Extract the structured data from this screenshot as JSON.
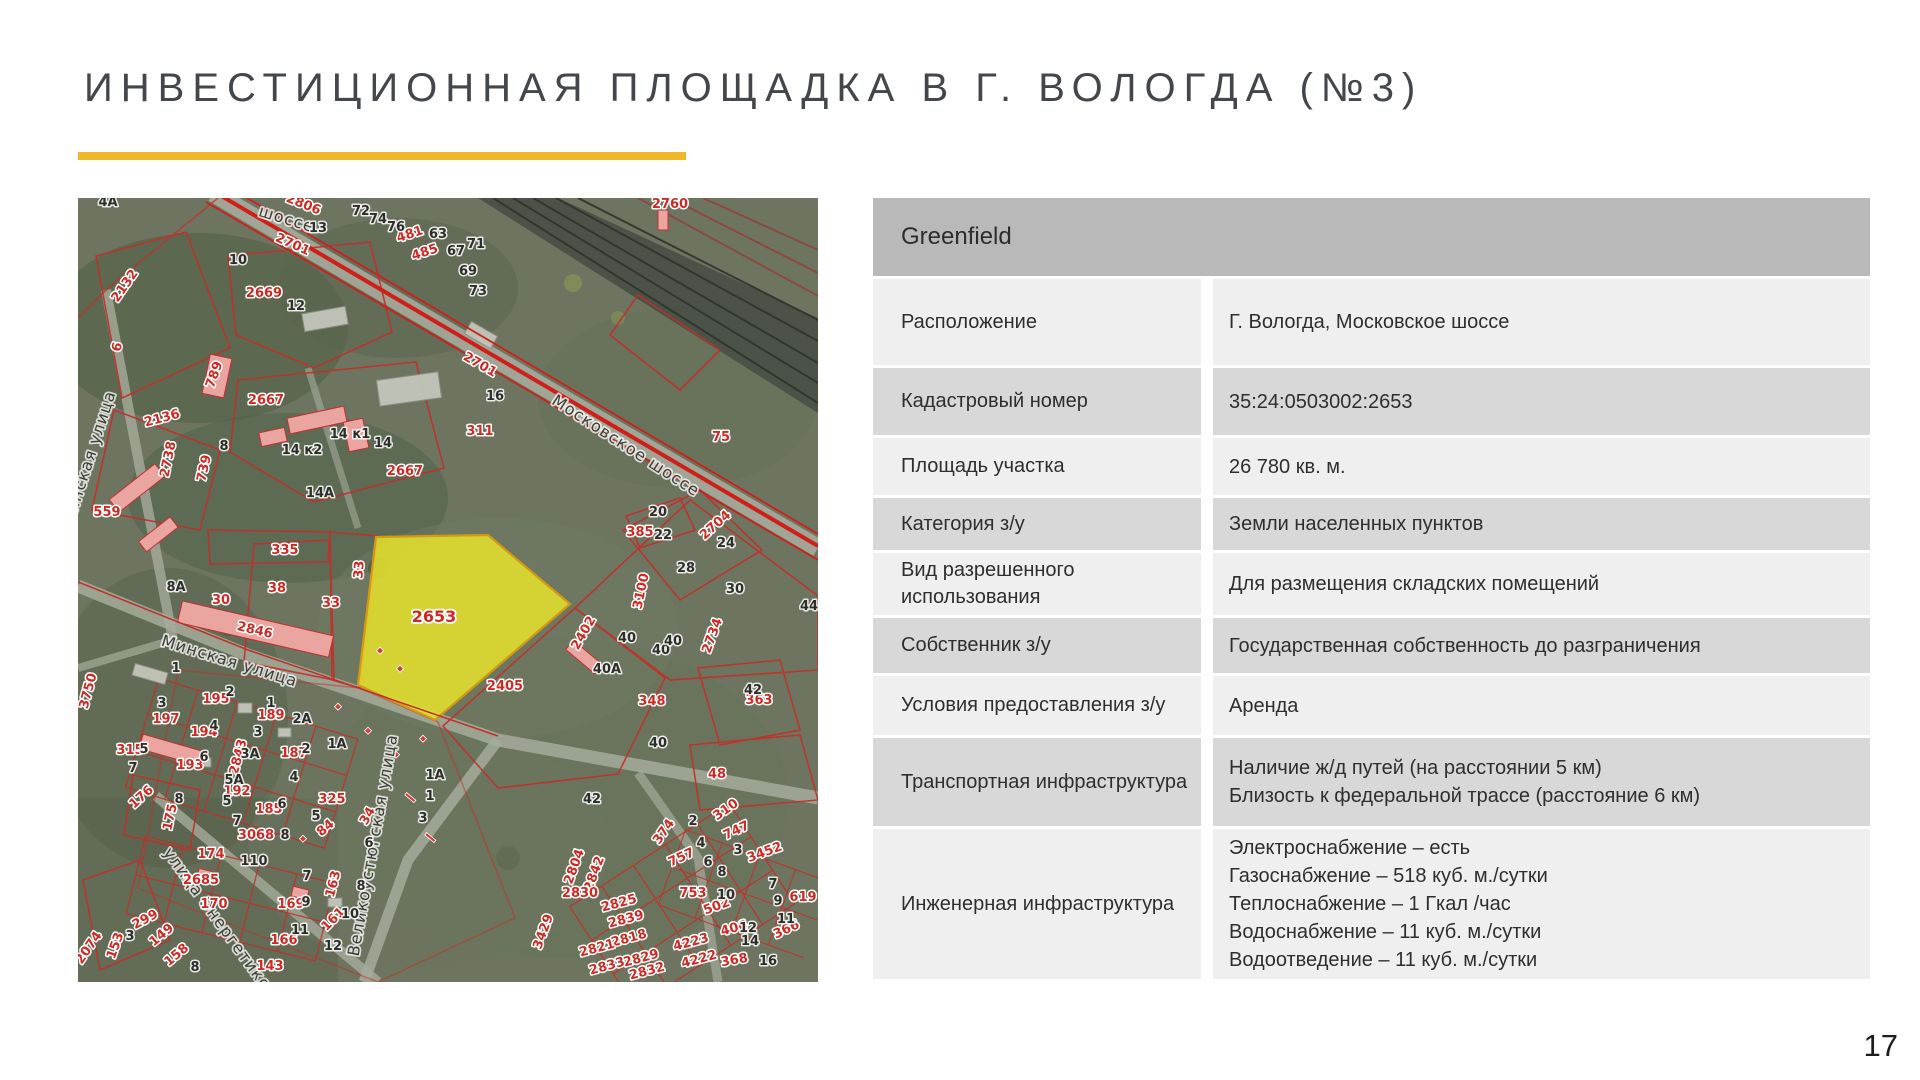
{
  "slide": {
    "title": "ИНВЕСТИЦИОННАЯ ПЛОЩАДКА В Г. ВОЛОГДА (№3)",
    "page_number": "17",
    "accent_color": "#EFB829"
  },
  "table": {
    "header": "Greenfield",
    "shade_light": "#EFEFEF",
    "shade_dark": "#D8D8D8",
    "header_shade": "#B9B9B9",
    "rows": [
      {
        "label": "Расположение",
        "values": [
          "Г. Вологда, Московское шоссе"
        ],
        "shade": "light"
      },
      {
        "label": "Кадастровый номер",
        "values": [
          "35:24:0503002:2653"
        ],
        "shade": "dark"
      },
      {
        "label": "Площадь участка",
        "values": [
          "26 780 кв. м."
        ],
        "shade": "light"
      },
      {
        "label": "Категория з/у",
        "values": [
          "Земли населенных пунктов"
        ],
        "shade": "dark"
      },
      {
        "label": "Вид разрешенного использования",
        "values": [
          "Для размещения складских помещений"
        ],
        "shade": "light"
      },
      {
        "label": "Собственник з/у",
        "values": [
          "Государственная собственность до разграничения"
        ],
        "shade": "dark"
      },
      {
        "label": "Условия предоставления з/у",
        "values": [
          "Аренда"
        ],
        "shade": "light"
      },
      {
        "label": "Транспортная инфраструктура",
        "values": [
          "Наличие ж/д путей (на расстоянии 5 км)",
          "Близость к федеральной трассе (расстояние 6 км)"
        ],
        "shade": "dark"
      },
      {
        "label": "Инженерная инфраструктура",
        "values": [
          "Электроснабжение – есть",
          "Газоснабжение – 518 куб. м./сутки",
          "Теплоснабжение – 1 Гкал /час",
          "Водоснабжение – 11 куб. м./сутки",
          "Водоотведение – 11 куб. м./сутки"
        ],
        "shade": "light"
      }
    ]
  },
  "map": {
    "highlighted_parcel": {
      "number": "2653",
      "fill": "#E4DF2E",
      "x": 356,
      "y": 424
    },
    "parcel_line_color": "#C22F28",
    "street_labels": [
      [
        "шоссе",
        207,
        26,
        17
      ],
      [
        "Московское шоссе",
        545,
        252,
        33
      ],
      [
        "Минская улица",
        150,
        468,
        17
      ],
      [
        "Минская улица",
        16,
        262,
        -72
      ],
      [
        "Великоустюгская улица",
        300,
        648,
        -80
      ],
      [
        "улица Энергетиков",
        138,
        728,
        54
      ]
    ],
    "red_labels": [
      [
        "2760",
        592,
        10,
        0
      ],
      [
        "2806",
        224,
        10,
        22
      ],
      [
        "2701",
        213,
        50,
        24
      ],
      [
        "2701",
        400,
        170,
        30
      ],
      [
        "2132",
        50,
        90,
        -55
      ],
      [
        "2669",
        186,
        99,
        0
      ],
      [
        "481",
        333,
        40,
        -18
      ],
      [
        "485",
        348,
        58,
        -18
      ],
      [
        "789",
        140,
        178,
        -70
      ],
      [
        "2667",
        188,
        206,
        0
      ],
      [
        "2667",
        327,
        277,
        0
      ],
      [
        "311",
        402,
        237,
        0
      ],
      [
        "75",
        643,
        243,
        0
      ],
      [
        "6",
        43,
        150,
        -75
      ],
      [
        "2136",
        85,
        224,
        -15
      ],
      [
        "2738",
        94,
        262,
        -78
      ],
      [
        "739",
        130,
        271,
        -78
      ],
      [
        "559",
        29,
        318,
        0
      ],
      [
        "335",
        207,
        356,
        0
      ],
      [
        "38",
        199,
        394,
        0
      ],
      [
        "33",
        285,
        372,
        -85
      ],
      [
        "33",
        253,
        409,
        0
      ],
      [
        "30",
        143,
        406,
        0
      ],
      [
        "2846",
        176,
        436,
        13
      ],
      [
        "3750",
        14,
        494,
        -75
      ],
      [
        "195",
        138,
        505,
        0
      ],
      [
        "197",
        88,
        525,
        0
      ],
      [
        "194",
        126,
        538,
        0
      ],
      [
        "193",
        112,
        571,
        0
      ],
      [
        "189",
        193,
        521,
        0
      ],
      [
        "187",
        216,
        559,
        0
      ],
      [
        "2843",
        164,
        560,
        -75
      ],
      [
        "315",
        52,
        556,
        0
      ],
      [
        "176",
        66,
        602,
        -42
      ],
      [
        "175",
        96,
        620,
        -78
      ],
      [
        "192",
        159,
        597,
        0
      ],
      [
        "185",
        191,
        615,
        0
      ],
      [
        "3068",
        178,
        641,
        0
      ],
      [
        "174",
        133,
        660,
        0
      ],
      [
        "2685",
        123,
        686,
        0
      ],
      [
        "170",
        136,
        710,
        0
      ],
      [
        "325",
        254,
        605,
        0
      ],
      [
        "84",
        250,
        633,
        -40
      ],
      [
        "34",
        293,
        620,
        -60
      ],
      [
        "163",
        259,
        687,
        -75
      ],
      [
        "169",
        213,
        710,
        0
      ],
      [
        "161",
        258,
        724,
        -45
      ],
      [
        "2074",
        14,
        752,
        -55
      ],
      [
        "299",
        69,
        725,
        -28
      ],
      [
        "153",
        41,
        749,
        -70
      ],
      [
        "149",
        86,
        740,
        -40
      ],
      [
        "158",
        101,
        760,
        -40
      ],
      [
        "166",
        206,
        746,
        0
      ],
      [
        "143",
        192,
        772,
        0
      ],
      [
        "2402",
        509,
        437,
        -60
      ],
      [
        "2405",
        427,
        492,
        0
      ],
      [
        "348",
        574,
        507,
        0
      ],
      [
        "374",
        589,
        636,
        -55
      ],
      [
        "310",
        650,
        615,
        -35
      ],
      [
        "747",
        660,
        636,
        -25
      ],
      [
        "757",
        605,
        663,
        -25
      ],
      [
        "3452",
        688,
        658,
        -20
      ],
      [
        "753",
        615,
        699,
        0
      ],
      [
        "502",
        640,
        712,
        -20
      ],
      [
        "619",
        725,
        703,
        0
      ],
      [
        "406",
        657,
        734,
        -15
      ],
      [
        "366",
        710,
        735,
        -25
      ],
      [
        "4223",
        614,
        748,
        -15
      ],
      [
        "4222",
        622,
        765,
        -15
      ],
      [
        "368",
        657,
        766,
        -10
      ],
      [
        "2804",
        500,
        670,
        -70
      ],
      [
        "2842",
        520,
        677,
        -70
      ],
      [
        "2830",
        502,
        699,
        0
      ],
      [
        "2825",
        542,
        709,
        -15
      ],
      [
        "2839",
        549,
        725,
        -15
      ],
      [
        "3429",
        469,
        735,
        -70
      ],
      [
        "2818",
        552,
        744,
        -15
      ],
      [
        "2821",
        520,
        754,
        -15
      ],
      [
        "2829",
        564,
        764,
        -15
      ],
      [
        "2833",
        530,
        772,
        -15
      ],
      [
        "2832",
        570,
        777,
        -15
      ],
      [
        "385",
        562,
        338,
        0
      ],
      [
        "2704",
        640,
        330,
        -42
      ],
      [
        "3100",
        567,
        394,
        -78
      ],
      [
        "2734",
        638,
        439,
        -70
      ],
      [
        "363",
        681,
        506,
        0
      ],
      [
        "48",
        639,
        580,
        0
      ]
    ],
    "dark_labels": [
      [
        "4А",
        30,
        8
      ],
      [
        "13",
        240,
        34
      ],
      [
        "10",
        160,
        66
      ],
      [
        "12",
        218,
        112
      ],
      [
        "72",
        283,
        17
      ],
      [
        "74",
        300,
        25
      ],
      [
        "76",
        318,
        33
      ],
      [
        "63",
        360,
        40
      ],
      [
        "67",
        378,
        57
      ],
      [
        "71",
        398,
        50
      ],
      [
        "69",
        390,
        77
      ],
      [
        "73",
        400,
        97
      ],
      [
        "16",
        417,
        202
      ],
      [
        "8",
        146,
        252
      ],
      [
        "14 к1",
        272,
        240
      ],
      [
        "14",
        305,
        249
      ],
      [
        "14 к2",
        224,
        256
      ],
      [
        "14А",
        242,
        299
      ],
      [
        "8А",
        98,
        393
      ],
      [
        "20",
        580,
        318
      ],
      [
        "22",
        585,
        341
      ],
      [
        "24",
        648,
        349
      ],
      [
        "28",
        608,
        374
      ],
      [
        "30",
        657,
        395
      ],
      [
        "44",
        731,
        412
      ],
      [
        "40",
        583,
        456
      ],
      [
        "42",
        675,
        496
      ],
      [
        "40",
        580,
        549
      ],
      [
        "1",
        98,
        474
      ],
      [
        "2",
        152,
        498
      ],
      [
        "3",
        84,
        509
      ],
      [
        "4",
        136,
        532
      ],
      [
        "1",
        193,
        509
      ],
      [
        "2А",
        224,
        525
      ],
      [
        "3",
        180,
        538
      ],
      [
        "2",
        228,
        555
      ],
      [
        "1А",
        259,
        550
      ],
      [
        "5",
        66,
        555
      ],
      [
        "7",
        55,
        574
      ],
      [
        "6",
        126,
        563
      ],
      [
        "3А",
        172,
        560
      ],
      [
        "5А",
        156,
        586
      ],
      [
        "4",
        216,
        583
      ],
      [
        "5",
        149,
        607
      ],
      [
        "8",
        101,
        605
      ],
      [
        "6",
        204,
        610
      ],
      [
        "7",
        159,
        627
      ],
      [
        "8",
        207,
        641
      ],
      [
        "110",
        176,
        667
      ],
      [
        "5",
        238,
        622
      ],
      [
        "6",
        291,
        649
      ],
      [
        "8",
        283,
        692
      ],
      [
        "7",
        229,
        682
      ],
      [
        "9",
        228,
        708
      ],
      [
        "10",
        272,
        720
      ],
      [
        "11",
        222,
        736
      ],
      [
        "12",
        255,
        752
      ],
      [
        "3",
        52,
        742
      ],
      [
        "8",
        117,
        773
      ],
      [
        "40",
        549,
        444
      ],
      [
        "40",
        595,
        447
      ],
      [
        "40А",
        529,
        475
      ],
      [
        "42",
        514,
        605
      ],
      [
        "1А",
        357,
        581
      ],
      [
        "1",
        352,
        602
      ],
      [
        "3",
        345,
        624
      ],
      [
        "2",
        615,
        627
      ],
      [
        "4",
        623,
        649
      ],
      [
        "3",
        660,
        656
      ],
      [
        "6",
        630,
        668
      ],
      [
        "8",
        644,
        678
      ],
      [
        "7",
        695,
        690
      ],
      [
        "10",
        648,
        701
      ],
      [
        "9",
        700,
        707
      ],
      [
        "11",
        708,
        725
      ],
      [
        "12",
        670,
        734
      ],
      [
        "14",
        672,
        747
      ],
      [
        "16",
        690,
        767
      ]
    ]
  }
}
